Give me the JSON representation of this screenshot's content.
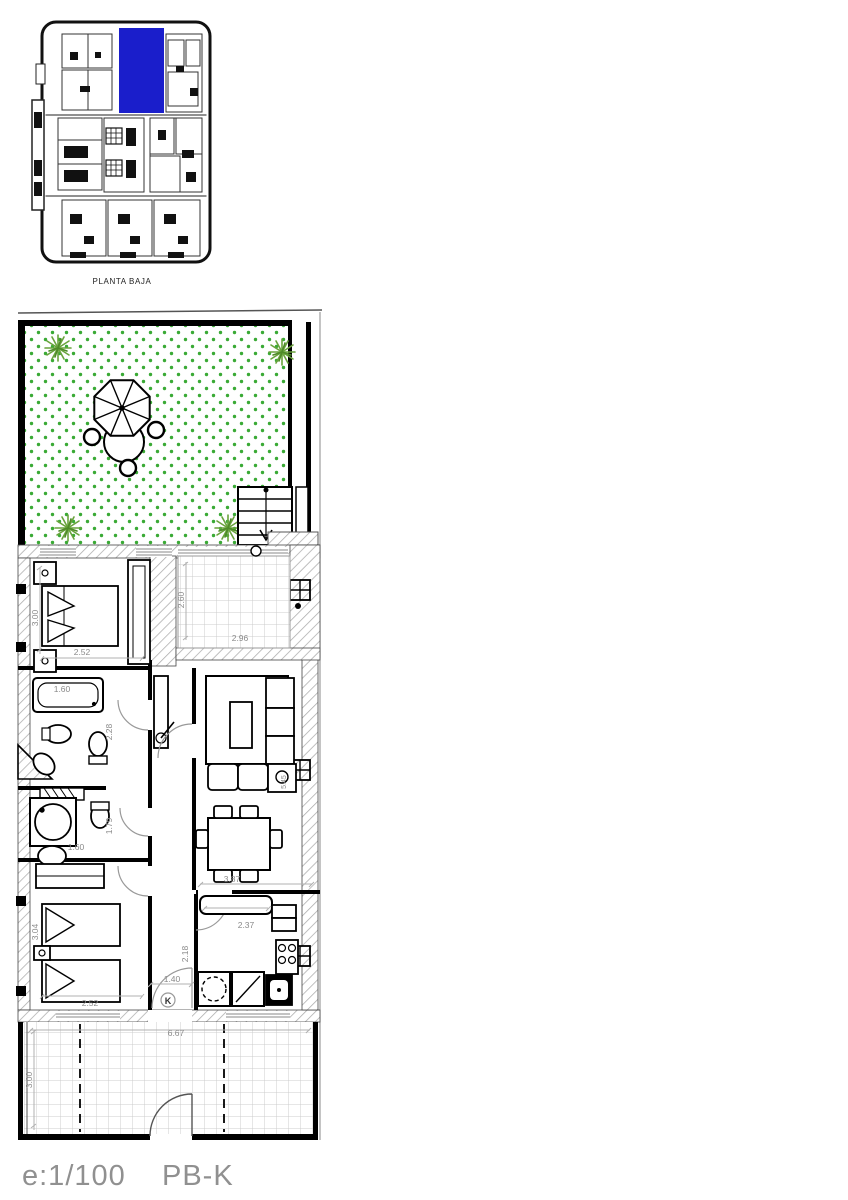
{
  "overview": {
    "caption": "PLANTA BAJA"
  },
  "colors": {
    "highlight": "#1a1ecb",
    "garden_dot": "#3aaa35",
    "palm": "#6fae3a",
    "dim_text": "#8a8a8a",
    "footer_text": "#909090"
  },
  "dims": {
    "bedroom1": {
      "width": "2.52",
      "height": "3.00"
    },
    "terrace_upper": {
      "width": "2.96",
      "height": "2.60"
    },
    "bath1": {
      "tub": "1.60",
      "height": "2.28"
    },
    "bath2": {
      "width": "1.60",
      "height": "1.79"
    },
    "living": {
      "width": "3.87",
      "side": "5.45"
    },
    "kitchen": {
      "width": "2.37"
    },
    "hall": {
      "height": "2.18",
      "entry_width": "1.40",
      "entry_key": "K"
    },
    "bedroom2": {
      "width": "2.52",
      "height": "3.04"
    },
    "terrace_lower": {
      "width": "6.67",
      "height": "3.00"
    }
  },
  "footer": {
    "scale": "e:1/100",
    "sheet": "PB-K"
  }
}
